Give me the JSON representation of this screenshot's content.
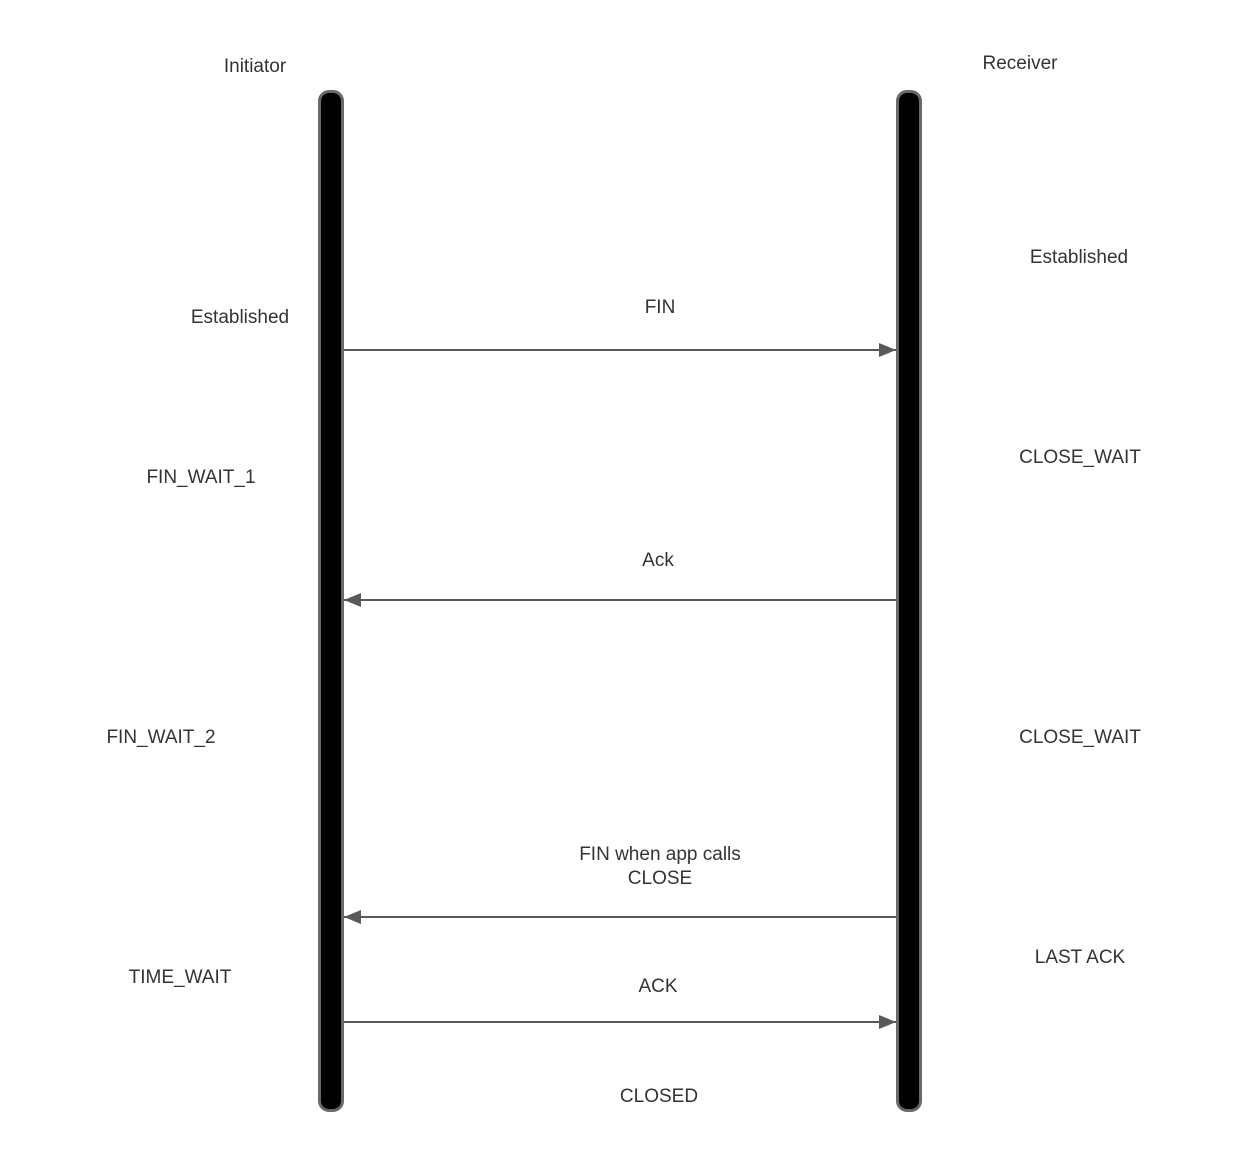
{
  "diagram": {
    "title": "TCP connection termination sequence",
    "actors": [
      {
        "name": "Initiator"
      },
      {
        "name": "Receiver"
      }
    ],
    "messages": [
      {
        "label": "FIN",
        "label2": "",
        "direction": "right",
        "from": "Initiator",
        "to": "Receiver"
      },
      {
        "label": "Ack",
        "label2": "",
        "direction": "left",
        "from": "Receiver",
        "to": "Initiator"
      },
      {
        "label": "FIN when app calls",
        "label2": "CLOSE",
        "direction": "left",
        "from": "Receiver",
        "to": "Initiator"
      },
      {
        "label": "ACK",
        "label2": "",
        "direction": "right",
        "from": "Initiator",
        "to": "Receiver"
      }
    ],
    "initiator_states": [
      "Established",
      "FIN_WAIT_1",
      "FIN_WAIT_2",
      "TIME_WAIT"
    ],
    "receiver_states": [
      "Established",
      "CLOSE_WAIT",
      "CLOSE_WAIT",
      "LAST ACK"
    ],
    "final_state": "CLOSED",
    "colors": {
      "lifeline_fill": "#000000",
      "lifeline_border": "#696969",
      "arrow": "#595959",
      "text": "#333333",
      "background": "#ffffff"
    }
  }
}
